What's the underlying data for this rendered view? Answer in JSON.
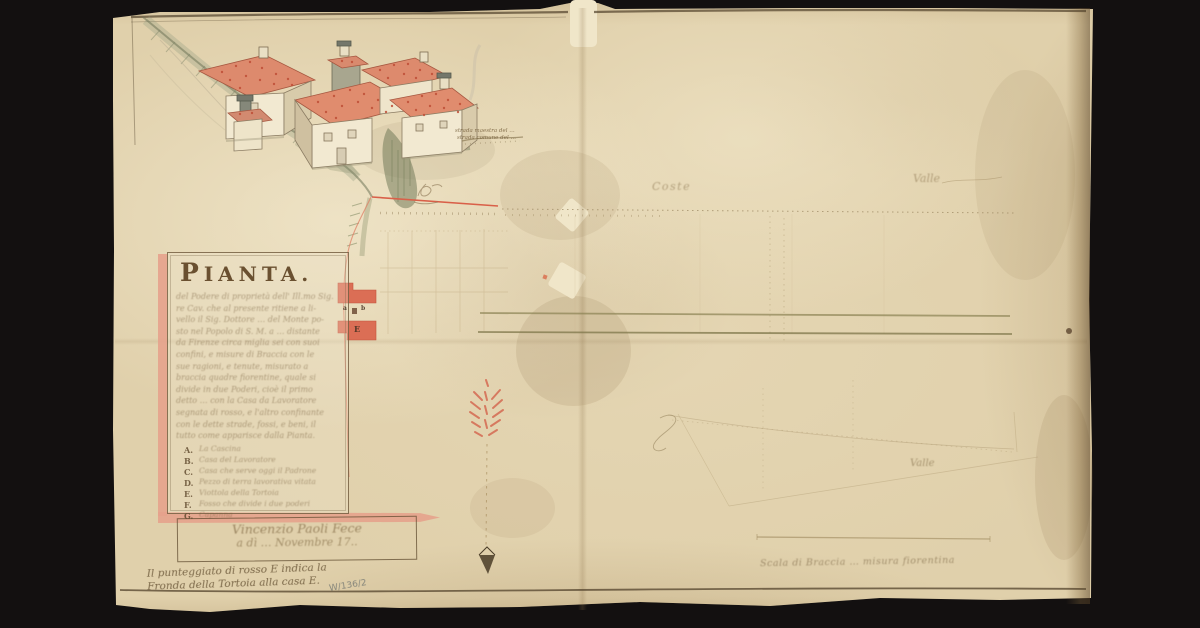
{
  "background_color": "#131010",
  "parchment": {
    "base_color": "#e0d0ab",
    "ink_color": "#51412b",
    "red_accent": "#d96049",
    "roof_color": "#dd8a6d",
    "pink_band": "#e6a28c",
    "olive_line": "#8a8153"
  },
  "document": {
    "title": "PIANTA.",
    "cartouche_body_lines": [
      "del Podere di proprietà dell' Ill.mo Sig.",
      "re Cav. che al presente ritiene a li-",
      "vello il Sig. Dottore … del Monte po-",
      "sto nel Popolo di S. M. a … distante",
      "da Firenze circa miglia sei con suoi",
      "confini, e misure di Braccia con le",
      "sue ragioni, e tenute, misurato a",
      "braccia quadre fiorentine, quale si",
      "divide in due Poderi, cioè il primo",
      "detto … con la Casa da Lavoratore",
      "segnata di rosso, e l'altro confinante",
      "con le dette strade, fossi, e beni, il",
      "tutto come apparisce dalla Pianta."
    ],
    "legend": [
      {
        "key": "A.",
        "label": "La Cascina"
      },
      {
        "key": "B.",
        "label": "Casa del Lavoratore"
      },
      {
        "key": "C.",
        "label": "Casa che serve oggi il Padrone"
      },
      {
        "key": "D.",
        "label": "Pezzo di terra lavorativa vitata"
      },
      {
        "key": "E.",
        "label": "Viottola della Tortoia"
      },
      {
        "key": "F.",
        "label": "Fosso che divide i due poderi"
      },
      {
        "key": "G.",
        "label": "Capanna"
      }
    ],
    "signature": {
      "line1": "Vincenzio Paoli Fece",
      "line2": "a dì … Novembre 17.."
    },
    "notes": {
      "red_dotted_line1": "Il punteggiato di rosso E indica la",
      "red_dotted_line2": "Fronda della Tortoia alla casa E.",
      "archive_ref": "W/136/2",
      "scale_note": "Scala di Braccia … misura fiorentina"
    },
    "field_labels": {
      "coste": "Coste",
      "valle_top": "Valle",
      "valle_bottom": "Valle",
      "road_line1": "strada maestra del …",
      "road_line2": "strada comune del …"
    },
    "plan_markers": {
      "a": "a",
      "b": "b",
      "e": "E"
    }
  }
}
